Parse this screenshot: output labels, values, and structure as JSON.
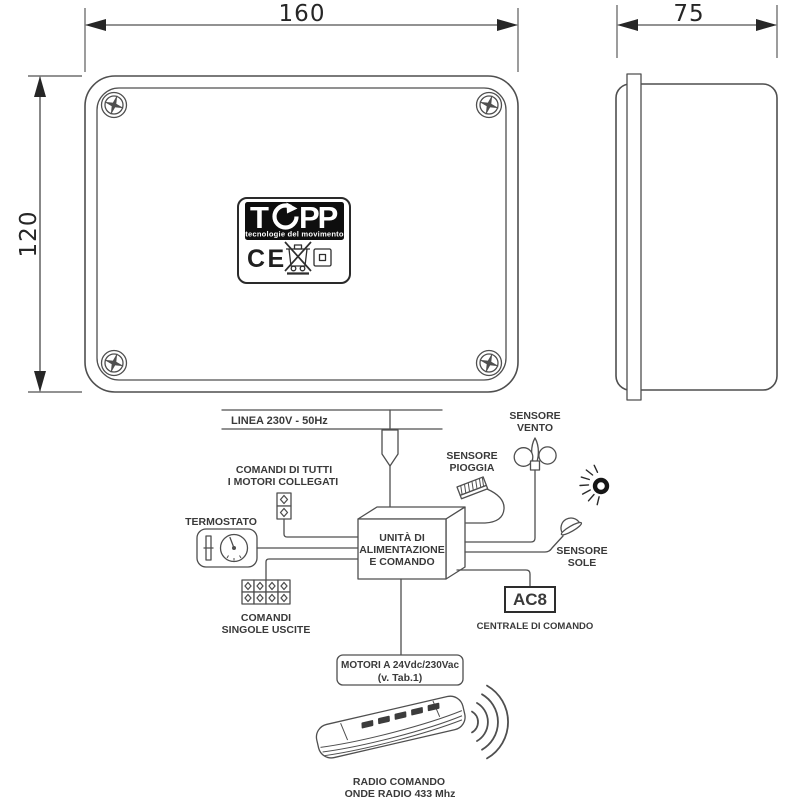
{
  "colors": {
    "line": "#4f4f4f",
    "label_text": "#3a3a3a",
    "dim": "#262626",
    "logo_bg": "#0e0e0e"
  },
  "dimensions": {
    "front_width": "160",
    "front_height": "120",
    "side_depth": "75"
  },
  "device_label": {
    "brand_t": "T",
    "brand_pp": "PP",
    "brand_full": "TOPP",
    "tagline": "tecnologie del movimento",
    "ce_mark": "CE"
  },
  "icons": {
    "screw-icon": "phillips screw head, circle with cross",
    "brand-o-arrow-icon": "circular arrow forming the O of TOPP",
    "weee-bin-icon": "crossed-out wheeled bin symbol",
    "double-insulation-icon": "square inside square symbol",
    "power-plug-icon": "mains drop plug on 230V line",
    "thermostat-icon": "thermostat dial with lever",
    "connector-2way-icon": "2-way terminal block",
    "connector-8way-icon": "4x2 terminal block grid",
    "rain-sensor-icon": "hatched slanted rain sensor",
    "wind-sensor-icon": "cup anemometer on pole",
    "sun-icon": "sun with rays",
    "sun-sensor-icon": "dome light sensor",
    "remote-control-icon": "handheld radio transmitter",
    "radio-waves-icon": "concentric transmission arcs"
  },
  "diagram": {
    "power_line_label": "LINEA 230V - 50Hz",
    "all_motors_cmd_line1": "COMANDI DI TUTTI",
    "all_motors_cmd_line2": "I MOTORI COLLEGATI",
    "thermostat_label": "TERMOSTATO",
    "single_outputs_line1": "COMANDI",
    "single_outputs_line2": "SINGOLE USCITE",
    "unit_line1": "UNITÀ DI",
    "unit_line2": "ALIMENTAZIONE",
    "unit_line3": "E COMANDO",
    "rain_line1": "SENSORE",
    "rain_line2": "PIOGGIA",
    "wind_line1": "SENSORE",
    "wind_line2": "VENTO",
    "sun_line1": "SENSORE",
    "sun_line2": "SOLE",
    "ac8_label": "AC8",
    "central_label": "CENTRALE DI COMANDO",
    "motors_line1": "MOTORI A 24Vdc/230Vac",
    "motors_line2": "(v. Tab.1)",
    "radio_line1": "RADIO COMANDO",
    "radio_line2": "ONDE RADIO 433 Mhz"
  }
}
